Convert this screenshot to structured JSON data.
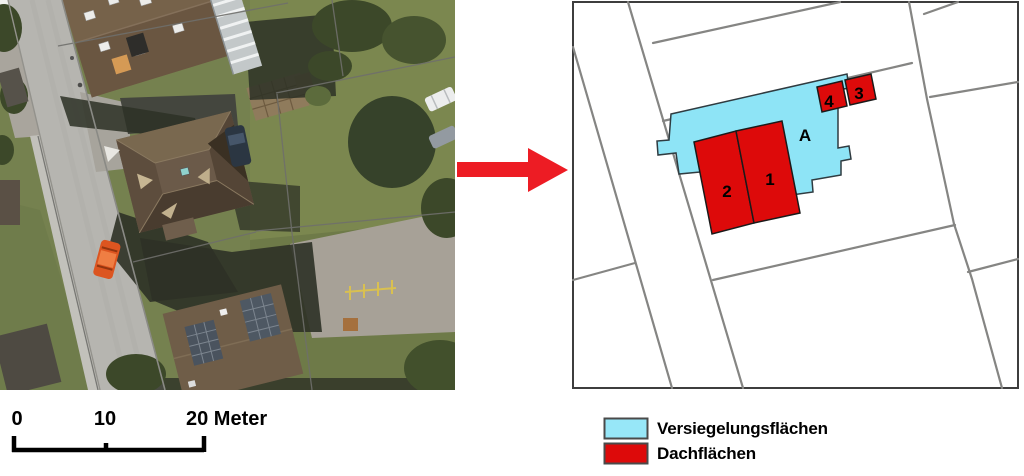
{
  "map_labels": {
    "roof_1": "1",
    "roof_2": "2",
    "roof_3": "3",
    "roof_4": "4",
    "sealed_area": "A"
  },
  "scalebar": {
    "tick_0": "0",
    "tick_10": "10",
    "tick_20": "20 Meter"
  },
  "legend": {
    "items": [
      {
        "label": "Versiegelungsflächen",
        "color": "#97e7f8"
      },
      {
        "label": "Dachflächen",
        "color": "#dd0a0a"
      }
    ]
  },
  "colors": {
    "sealed_fill": "#8ee4f6",
    "roof_fill": "#dd0a0a",
    "arrow": "#ed1c24",
    "parcel_line": "#858583",
    "map_frame": "#3d3d3d"
  }
}
